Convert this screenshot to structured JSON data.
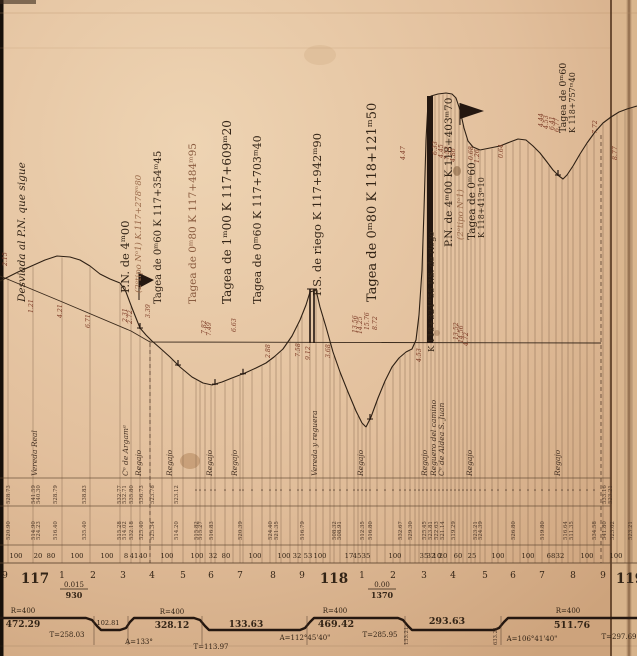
{
  "colors": {
    "paper_light": "#edd3b2",
    "paper_base": "#e2bf9c",
    "paper_shadow": "#cda37b",
    "edge_black": "#17100a",
    "fold_line": "#55371f",
    "crease": "#8a6746",
    "right_strip": "#dab78f",
    "ink_dark": "#33241688",
    "ink": "#332416",
    "ink_mid": "#4a3526",
    "ink_faint": "#8a6c52",
    "red": "#7d3b26",
    "faded": "#9a6a4a",
    "rule": "#b89068"
  },
  "structure_labels": [
    {
      "x": 25,
      "y": 302,
      "t": "Desviada al P.N. que sigue",
      "s": 10.5,
      "i": 1
    },
    {
      "x": 129,
      "y": 293,
      "t": "P.N. de 4ᵐ00",
      "s": 11.5
    },
    {
      "x": 141,
      "y": 293,
      "t": "(2ᵒtipo Nᵒ1)  K.117+278ᵐ80",
      "s": 8.5,
      "i": 1,
      "c": "#9a6a4a"
    },
    {
      "x": 161,
      "y": 304,
      "t": "Tagea de 0ᵐ60  K 117+354ᵐ45",
      "s": 10
    },
    {
      "x": 196,
      "y": 304,
      "t": "Tagea de 0ᵐ80  K 117+484ᵐ95",
      "s": 10.5,
      "c": "#8a5c40"
    },
    {
      "x": 231,
      "y": 304,
      "t": "Tagea de 1ᵐ00  K 117+609ᵐ20",
      "s": 12
    },
    {
      "x": 261,
      "y": 304,
      "t": "Tagea de 0ᵐ60  K 117+703ᵐ40",
      "s": 11
    },
    {
      "x": 321,
      "y": 296,
      "t": "P.S. de riego  K 117+942ᵐ90",
      "s": 11.5
    },
    {
      "x": 376,
      "y": 302,
      "t": "Tagea de 0ᵐ80  K 118+121ᵐ50",
      "s": 13
    },
    {
      "x": 434,
      "y": 352,
      "t": "K 118+324ᵐ55 P.S. de riego",
      "s": 8.5
    },
    {
      "x": 452,
      "y": 247,
      "t": "P.N. de 4ᵐ00 K.118+403ᵐ70",
      "s": 10.5
    },
    {
      "x": 463,
      "y": 240,
      "t": "(2ᵒtipo Nᵒ1)",
      "s": 8.5,
      "i": 1,
      "c": "#9a6a4a"
    },
    {
      "x": 475,
      "y": 240,
      "t": "Tagea de 0ᵐ60",
      "s": 10.5
    },
    {
      "x": 484,
      "y": 238,
      "t": "K 118+413ᵐ10",
      "s": 8
    },
    {
      "x": 566,
      "y": 133,
      "t": "Tagea de 0ᵐ60",
      "s": 9.5
    },
    {
      "x": 575,
      "y": 133,
      "t": "K 118+757ᵐ40",
      "s": 8
    }
  ],
  "red_ordinates": [
    {
      "x": 7,
      "y": 266,
      "t": "2.15"
    },
    {
      "x": 33,
      "y": 313,
      "t": "1.21"
    },
    {
      "x": 62,
      "y": 318,
      "t": "4.21"
    },
    {
      "x": 90,
      "y": 328,
      "t": "6.71"
    },
    {
      "x": 127,
      "y": 322,
      "t": "2.31"
    },
    {
      "x": 132,
      "y": 324,
      "t": "2.72"
    },
    {
      "x": 150,
      "y": 318,
      "t": "3.39"
    },
    {
      "x": 206,
      "y": 334,
      "t": "7.82"
    },
    {
      "x": 211,
      "y": 336,
      "t": "7.49"
    },
    {
      "x": 236,
      "y": 332,
      "t": "6.63"
    },
    {
      "x": 270,
      "y": 358,
      "t": "2.88"
    },
    {
      "x": 300,
      "y": 357,
      "t": "7.58"
    },
    {
      "x": 310,
      "y": 360,
      "t": "9.12"
    },
    {
      "x": 330,
      "y": 358,
      "t": "3.68"
    },
    {
      "x": 357,
      "y": 333,
      "t": "13.56"
    },
    {
      "x": 362,
      "y": 334,
      "t": "14.25"
    },
    {
      "x": 369,
      "y": 330,
      "t": "15.76"
    },
    {
      "x": 377,
      "y": 330,
      "t": "8.72"
    },
    {
      "x": 405,
      "y": 160,
      "t": "4.47"
    },
    {
      "x": 421,
      "y": 362,
      "t": "4.53"
    },
    {
      "x": 437,
      "y": 155,
      "t": "6.33"
    },
    {
      "x": 443,
      "y": 158,
      "t": "4.45"
    },
    {
      "x": 449,
      "y": 160,
      "t": "7.52"
    },
    {
      "x": 455,
      "y": 162,
      "t": "4.86"
    },
    {
      "x": 458,
      "y": 340,
      "t": "13.52"
    },
    {
      "x": 463,
      "y": 343,
      "t": "14.56"
    },
    {
      "x": 468,
      "y": 346,
      "t": "4.72"
    },
    {
      "x": 473,
      "y": 160,
      "t": "0.68"
    },
    {
      "x": 479,
      "y": 163,
      "t": "1.26"
    },
    {
      "x": 503,
      "y": 158,
      "t": "0.64"
    },
    {
      "x": 543,
      "y": 127,
      "t": "4.44"
    },
    {
      "x": 548,
      "y": 129,
      "t": "4.53"
    },
    {
      "x": 554,
      "y": 130,
      "t": "6.41"
    },
    {
      "x": 559,
      "y": 132,
      "t": "6.77"
    },
    {
      "x": 597,
      "y": 134,
      "t": "7.72"
    },
    {
      "x": 617,
      "y": 160,
      "t": "8.77"
    }
  ],
  "site_labels": [
    {
      "x": 37,
      "t": "Vereda Real"
    },
    {
      "x": 128,
      "t": "Cᵒ de Argamᵃ"
    },
    {
      "x": 141,
      "t": "Regajo"
    },
    {
      "x": 172,
      "t": "Regajo"
    },
    {
      "x": 212,
      "t": "Regajo"
    },
    {
      "x": 237,
      "t": "Regajo"
    },
    {
      "x": 317,
      "t": "Vereda y reguera"
    },
    {
      "x": 363,
      "t": "Regajo"
    },
    {
      "x": 427,
      "t": "Regajo"
    },
    {
      "x": 436,
      "t": "Reguero del camino"
    },
    {
      "x": 444,
      "t": "Cᵒ de Aldea S. Juan"
    },
    {
      "x": 472,
      "t": "Regajo"
    },
    {
      "x": 560,
      "t": "Regajo"
    }
  ],
  "elevations_row_a": [
    {
      "x": 8,
      "t": "528.73"
    },
    {
      "x": 33,
      "t": "541.59"
    },
    {
      "x": 38,
      "t": "540.30"
    },
    {
      "x": 55,
      "t": "528.79"
    },
    {
      "x": 84,
      "t": "538.83"
    },
    {
      "x": 119,
      "t": "532.77"
    },
    {
      "x": 124,
      "t": "532.71"
    },
    {
      "x": 131,
      "t": "535.80"
    },
    {
      "x": 141,
      "t": "536.73"
    },
    {
      "x": 152,
      "t": "523.78"
    },
    {
      "x": 176,
      "t": "523.12"
    },
    {
      "x": 604,
      "t": "533.16"
    },
    {
      "x": 610,
      "t": "523.21"
    }
  ],
  "elevations_row_b": [
    {
      "x": 8,
      "t": "520.90"
    },
    {
      "x": 33,
      "t": "514.90"
    },
    {
      "x": 38,
      "t": "524.23"
    },
    {
      "x": 55,
      "t": "516.40"
    },
    {
      "x": 84,
      "t": "535.40"
    },
    {
      "x": 119,
      "t": "515.28"
    },
    {
      "x": 124,
      "t": "514.02"
    },
    {
      "x": 131,
      "t": "532.18"
    },
    {
      "x": 141,
      "t": "525.40"
    },
    {
      "x": 152,
      "t": "525.34"
    },
    {
      "x": 176,
      "t": "514.20"
    },
    {
      "x": 196,
      "t": "515.82"
    },
    {
      "x": 200,
      "t": "515.27"
    },
    {
      "x": 211,
      "t": "516.83"
    },
    {
      "x": 240,
      "t": "520.39"
    },
    {
      "x": 270,
      "t": "524.40"
    },
    {
      "x": 276,
      "t": "521.35"
    },
    {
      "x": 302,
      "t": "516.79"
    },
    {
      "x": 334,
      "t": "508.32"
    },
    {
      "x": 339,
      "t": "508.91"
    },
    {
      "x": 362,
      "t": "512.35"
    },
    {
      "x": 370,
      "t": "516.80"
    },
    {
      "x": 400,
      "t": "532.67"
    },
    {
      "x": 410,
      "t": "529.30"
    },
    {
      "x": 424,
      "t": "525.45"
    },
    {
      "x": 430,
      "t": "523.81"
    },
    {
      "x": 436,
      "t": "522.63"
    },
    {
      "x": 442,
      "t": "521.14"
    },
    {
      "x": 453,
      "t": "519.29"
    },
    {
      "x": 475,
      "t": "523.21"
    },
    {
      "x": 480,
      "t": "524.39"
    },
    {
      "x": 513,
      "t": "526.80"
    },
    {
      "x": 542,
      "t": "519.80"
    },
    {
      "x": 565,
      "t": "516.64"
    },
    {
      "x": 571,
      "t": "511.35"
    },
    {
      "x": 594,
      "t": "534.58"
    },
    {
      "x": 604,
      "t": "541.80"
    },
    {
      "x": 612,
      "t": "523.02"
    },
    {
      "x": 630,
      "t": "523.21"
    }
  ],
  "distances": [
    {
      "x": 16,
      "t": "100"
    },
    {
      "x": 38,
      "t": "20"
    },
    {
      "x": 51,
      "t": "80"
    },
    {
      "x": 77,
      "t": "100"
    },
    {
      "x": 107,
      "t": "100"
    },
    {
      "x": 126,
      "t": "8"
    },
    {
      "x": 134,
      "t": "41"
    },
    {
      "x": 143,
      "t": "40"
    },
    {
      "x": 167,
      "t": "100"
    },
    {
      "x": 197,
      "t": "100"
    },
    {
      "x": 213,
      "t": "32"
    },
    {
      "x": 226,
      "t": "80"
    },
    {
      "x": 255,
      "t": "100"
    },
    {
      "x": 284,
      "t": "100"
    },
    {
      "x": 297,
      "t": "32"
    },
    {
      "x": 308,
      "t": "53"
    },
    {
      "x": 320,
      "t": "100"
    },
    {
      "x": 349,
      "t": "17"
    },
    {
      "x": 357,
      "t": "45"
    },
    {
      "x": 366,
      "t": "35"
    },
    {
      "x": 395,
      "t": "100"
    },
    {
      "x": 424,
      "t": "35"
    },
    {
      "x": 431,
      "t": "32"
    },
    {
      "x": 437,
      "t": "10"
    },
    {
      "x": 443,
      "t": "20"
    },
    {
      "x": 458,
      "t": "60"
    },
    {
      "x": 472,
      "t": "25"
    },
    {
      "x": 498,
      "t": "100"
    },
    {
      "x": 528,
      "t": "100"
    },
    {
      "x": 551,
      "t": "68"
    },
    {
      "x": 560,
      "t": "32"
    },
    {
      "x": 587,
      "t": "100"
    },
    {
      "x": 616,
      "t": "100"
    }
  ],
  "stations": [
    {
      "x": 5,
      "t": "9"
    },
    {
      "x": 35,
      "t": "117",
      "big": 1
    },
    {
      "x": 62,
      "t": "1"
    },
    {
      "x": 93,
      "t": "2"
    },
    {
      "x": 123,
      "t": "3"
    },
    {
      "x": 152,
      "t": "4"
    },
    {
      "x": 183,
      "t": "5"
    },
    {
      "x": 211,
      "t": "6"
    },
    {
      "x": 240,
      "t": "7"
    },
    {
      "x": 273,
      "t": "8"
    },
    {
      "x": 302,
      "t": "9"
    },
    {
      "x": 334,
      "t": "118",
      "big": 1
    },
    {
      "x": 362,
      "t": "1"
    },
    {
      "x": 393,
      "t": "2"
    },
    {
      "x": 424,
      "t": "3"
    },
    {
      "x": 453,
      "t": "4"
    },
    {
      "x": 485,
      "t": "5"
    },
    {
      "x": 513,
      "t": "6"
    },
    {
      "x": 542,
      "t": "7"
    },
    {
      "x": 573,
      "t": "8"
    },
    {
      "x": 603,
      "t": "9"
    },
    {
      "x": 630,
      "t": "119",
      "big": 1
    }
  ],
  "gradients": [
    {
      "x": 74,
      "rate": "0.015",
      "length": "930"
    },
    {
      "x": 382,
      "rate": "0.00",
      "length": "1370"
    }
  ],
  "alignment": {
    "polyline": [
      [
        0,
        618
      ],
      [
        86,
        618
      ],
      [
        92,
        620
      ],
      [
        97,
        626
      ],
      [
        101,
        630
      ],
      [
        120,
        630
      ],
      [
        126,
        628
      ],
      [
        130,
        622
      ],
      [
        134,
        618
      ],
      [
        194,
        618
      ],
      [
        200,
        620
      ],
      [
        205,
        626
      ],
      [
        209,
        630
      ],
      [
        300,
        630
      ],
      [
        305,
        628
      ],
      [
        310,
        622
      ],
      [
        314,
        618
      ],
      [
        398,
        618
      ],
      [
        403,
        620
      ],
      [
        408,
        626
      ],
      [
        412,
        630
      ],
      [
        494,
        630
      ],
      [
        499,
        628
      ],
      [
        504,
        622
      ],
      [
        508,
        618
      ],
      [
        637,
        618
      ]
    ],
    "labels": [
      {
        "x": 23,
        "y": 613,
        "t": "R=400",
        "s": 7
      },
      {
        "x": 23,
        "y": 627,
        "t": "472.29",
        "s": 9,
        "b": 1
      },
      {
        "x": 67,
        "y": 637,
        "t": "T=258.03",
        "s": 7
      },
      {
        "x": 108,
        "y": 625,
        "t": "102.81",
        "s": 6.5
      },
      {
        "x": 172,
        "y": 614,
        "t": "R=400",
        "s": 7
      },
      {
        "x": 172,
        "y": 628,
        "t": "328.12",
        "s": 9,
        "b": 1
      },
      {
        "x": 139,
        "y": 644,
        "t": "A=133°",
        "s": 7
      },
      {
        "x": 211,
        "y": 649,
        "t": "T=113.97",
        "s": 7
      },
      {
        "x": 246,
        "y": 627,
        "t": "133.63",
        "s": 9,
        "b": 1
      },
      {
        "x": 335,
        "y": 613,
        "t": "R=400",
        "s": 7
      },
      {
        "x": 336,
        "y": 627,
        "t": "469.42",
        "s": 9.5,
        "b": 1
      },
      {
        "x": 305,
        "y": 640,
        "t": "A=112°45'40\"",
        "s": 7
      },
      {
        "x": 380,
        "y": 637,
        "t": "T=285.95",
        "s": 7
      },
      {
        "x": 447,
        "y": 624,
        "t": "293.63",
        "s": 9.5,
        "b": 1
      },
      {
        "x": 568,
        "y": 613,
        "t": "R=400",
        "s": 7
      },
      {
        "x": 572,
        "y": 628,
        "t": "511.76",
        "s": 9.5,
        "b": 1
      },
      {
        "x": 532,
        "y": 641,
        "t": "A=106°41'40\"",
        "s": 7
      },
      {
        "x": 619,
        "y": 639,
        "t": "T=297.69",
        "s": 7
      }
    ],
    "tick_numbers": [
      {
        "x": 408,
        "y": 645,
        "t": "133.21"
      },
      {
        "x": 497,
        "y": 645,
        "t": "633.21"
      }
    ],
    "ramp_marks": [
      94,
      128,
      202,
      307,
      405,
      501
    ]
  },
  "profile": {
    "terrain": [
      [
        0,
        281
      ],
      [
        18,
        272
      ],
      [
        45,
        260
      ],
      [
        57,
        256
      ],
      [
        70,
        257
      ],
      [
        80,
        260
      ],
      [
        90,
        266
      ],
      [
        100,
        274
      ],
      [
        110,
        279
      ],
      [
        120,
        283
      ],
      [
        126,
        292
      ],
      [
        132,
        308
      ],
      [
        140,
        328
      ],
      [
        146,
        335
      ],
      [
        152,
        341
      ],
      [
        160,
        348
      ],
      [
        170,
        357
      ],
      [
        180,
        367
      ],
      [
        192,
        377
      ],
      [
        203,
        383
      ],
      [
        212,
        385
      ],
      [
        222,
        382
      ],
      [
        232,
        378
      ],
      [
        245,
        373
      ],
      [
        256,
        368
      ],
      [
        266,
        363
      ],
      [
        274,
        357
      ],
      [
        283,
        349
      ],
      [
        292,
        336
      ],
      [
        300,
        320
      ],
      [
        306,
        305
      ],
      [
        310,
        292
      ],
      [
        316,
        290
      ],
      [
        320,
        307
      ],
      [
        326,
        327
      ],
      [
        333,
        352
      ],
      [
        340,
        372
      ],
      [
        348,
        392
      ],
      [
        356,
        411
      ],
      [
        362,
        423
      ],
      [
        366,
        427
      ],
      [
        371,
        417
      ],
      [
        378,
        398
      ],
      [
        385,
        381
      ],
      [
        392,
        367
      ],
      [
        399,
        358
      ],
      [
        406,
        352
      ],
      [
        412,
        349
      ],
      [
        416,
        340
      ],
      [
        419,
        315
      ],
      [
        422,
        270
      ],
      [
        424,
        210
      ],
      [
        426,
        140
      ],
      [
        428,
        103
      ],
      [
        431,
        96
      ],
      [
        438,
        94
      ],
      [
        446,
        93
      ],
      [
        452,
        94
      ],
      [
        456,
        98
      ],
      [
        460,
        110
      ],
      [
        464,
        128
      ],
      [
        468,
        141
      ],
      [
        473,
        147
      ],
      [
        480,
        150
      ],
      [
        490,
        148
      ],
      [
        500,
        146
      ],
      [
        510,
        142
      ],
      [
        518,
        139
      ],
      [
        526,
        140
      ],
      [
        533,
        146
      ],
      [
        540,
        153
      ],
      [
        547,
        162
      ],
      [
        553,
        170
      ],
      [
        559,
        176
      ],
      [
        563,
        179
      ],
      [
        567,
        175
      ],
      [
        573,
        166
      ],
      [
        580,
        154
      ],
      [
        587,
        143
      ],
      [
        595,
        132
      ],
      [
        603,
        123
      ],
      [
        611,
        117
      ],
      [
        619,
        112
      ],
      [
        627,
        109
      ],
      [
        637,
        106
      ]
    ],
    "grade_line": [
      [
        0,
        276
      ],
      [
        60,
        301
      ],
      [
        131,
        331
      ],
      [
        150,
        342
      ],
      [
        601,
        343
      ]
    ],
    "ordinates_x": [
      8,
      33,
      62,
      90,
      120,
      131,
      140,
      150,
      162,
      172,
      183,
      196,
      200,
      205,
      211,
      215,
      225,
      233,
      240,
      243,
      252,
      262,
      270,
      276,
      281,
      290,
      298,
      302,
      310,
      316,
      323,
      330,
      334,
      340,
      347,
      354,
      358,
      362,
      366,
      370,
      377,
      385,
      393,
      400,
      405,
      410,
      415,
      419,
      423,
      427,
      431,
      435,
      439,
      443,
      447,
      451,
      455,
      459,
      463,
      467,
      471,
      475,
      480,
      485,
      492,
      498,
      506,
      513,
      520,
      528,
      535,
      542,
      549,
      556,
      562,
      568,
      573,
      580,
      587,
      594,
      603,
      610,
      617,
      625,
      632
    ],
    "dashed_verticals": [
      {
        "x": 150,
        "y1": 343,
        "y2": 563
      },
      {
        "x": 601,
        "y1": 135,
        "y2": 563
      }
    ],
    "band_lines_y": [
      478,
      506,
      545,
      563
    ],
    "culvert_ticks": [
      140,
      178,
      215,
      243,
      370,
      558
    ]
  },
  "symbols": {
    "flags": [
      {
        "pts": [
          [
            139,
            273
          ],
          [
            154,
            280
          ],
          [
            139,
            288
          ]
        ],
        "pole": [
          139,
          272,
          139,
          300
        ]
      },
      {
        "pts": [
          [
            460,
            103
          ],
          [
            484,
            111
          ],
          [
            460,
            119
          ]
        ],
        "pole": [
          460,
          103,
          460,
          125
        ]
      }
    ],
    "bridge_lines": [
      {
        "x": 310,
        "y1": 289,
        "y2": 343
      },
      {
        "x": 314,
        "y1": 289,
        "y2": 343
      }
    ],
    "bridge_bar": {
      "x": 427,
      "y": 96,
      "w": 6,
      "h": 247
    }
  }
}
